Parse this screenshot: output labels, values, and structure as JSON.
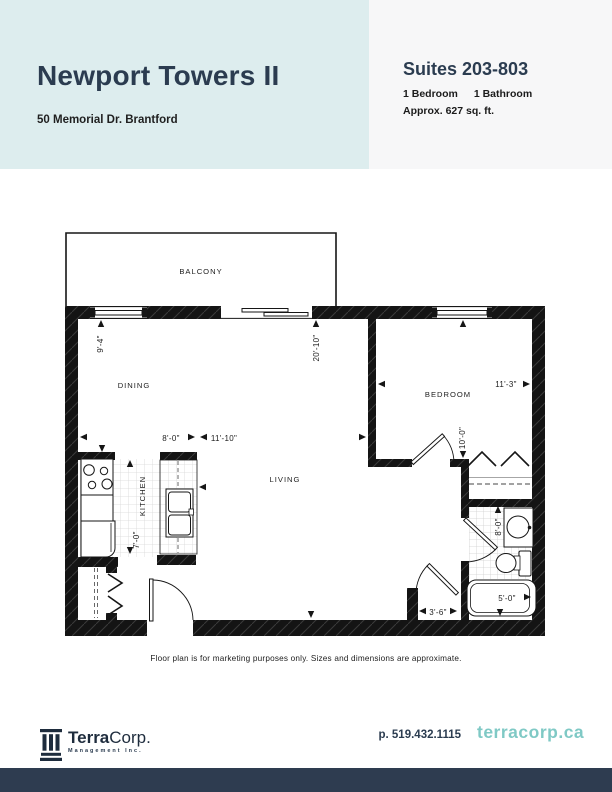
{
  "header": {
    "title": "Newport Towers II",
    "address": "50 Memorial Dr. Brantford",
    "suites": "Suites 203-803",
    "bedrooms": "1 Bedroom",
    "bathrooms": "1 Bathroom",
    "area": "Approx. 627 sq. ft."
  },
  "floor_plan": {
    "labels": {
      "balcony": "BALCONY",
      "dining": "DINING",
      "kitchen": "KITCHEN",
      "living": "LIVING",
      "bedroom": "BEDROOM"
    },
    "dimensions": {
      "dining_width": "9'-4\"",
      "living_length": "20'-10\"",
      "kitchen_width": "8'-0\"",
      "living_width": "11'-10\"",
      "kitchen_depth": "7'-0\"",
      "bedroom_width": "11'-3\"",
      "bedroom_depth": "10'-0\"",
      "bathroom_depth": "8'-0\"",
      "hall_width": "3'-6\"",
      "tub_length": "5'-0\""
    },
    "disclaimer": "Floor plan is for marketing purposes only. Sizes and dimensions are approximate."
  },
  "footer": {
    "logo_primary": "Terra",
    "logo_secondary": "Corp.",
    "logo_subtitle": "Management Inc.",
    "phone": "p. 519.432.1115",
    "website": "terracorp.ca"
  },
  "colors": {
    "mint": "#ddedee",
    "light_gray": "#f7f7f8",
    "navy": "#2b3c50",
    "teal": "#7fc9c5",
    "footer_bar": "#2e3c50",
    "wall": "#161616"
  }
}
